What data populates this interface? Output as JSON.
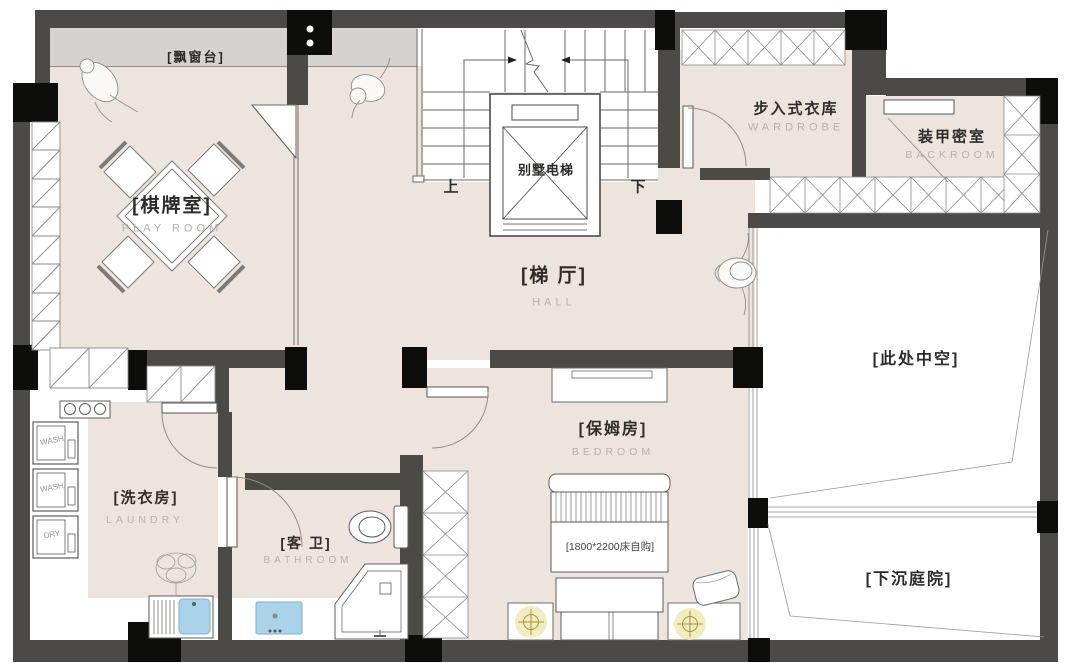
{
  "rooms": {
    "bay_window": {
      "label": "[飘窗台]"
    },
    "play_room": {
      "label": "[棋牌室]",
      "sub": "PLAY ROOM"
    },
    "elevator": {
      "label": "别墅电梯"
    },
    "stairs": {
      "up": "上",
      "down": "下"
    },
    "wardrobe": {
      "label": "步入式衣库",
      "sub": "WARDROBE"
    },
    "backroom": {
      "label": "装甲密室",
      "sub": "BACKROOM"
    },
    "hall": {
      "label": "[梯 厅]",
      "sub": "HALL"
    },
    "void": {
      "label": "[此处中空]"
    },
    "laundry": {
      "label": "[洗衣房]",
      "sub": "LAUNDRY"
    },
    "bathroom": {
      "label": "[客 卫]",
      "sub": "BATHROOM"
    },
    "bedroom": {
      "label": "[保姆房]",
      "sub": "BEDROOM",
      "bed_note": "[1800*2200床自购]"
    },
    "courtyard": {
      "label": "[下沉庭院]"
    }
  },
  "appliances": {
    "washer1": "WASH",
    "washer2": "WASH",
    "dryer": "DRY"
  },
  "palette": {
    "wall": "#4b4a47",
    "column": "#0d0d0c",
    "floor": "#ede5dd",
    "sill_gray": "#d5d2cf",
    "sink_blue": "#aad2e8",
    "lamp_yellow": "#f3ecc2",
    "line": "#6a6a68",
    "sublabel": "#b5b1ab"
  }
}
